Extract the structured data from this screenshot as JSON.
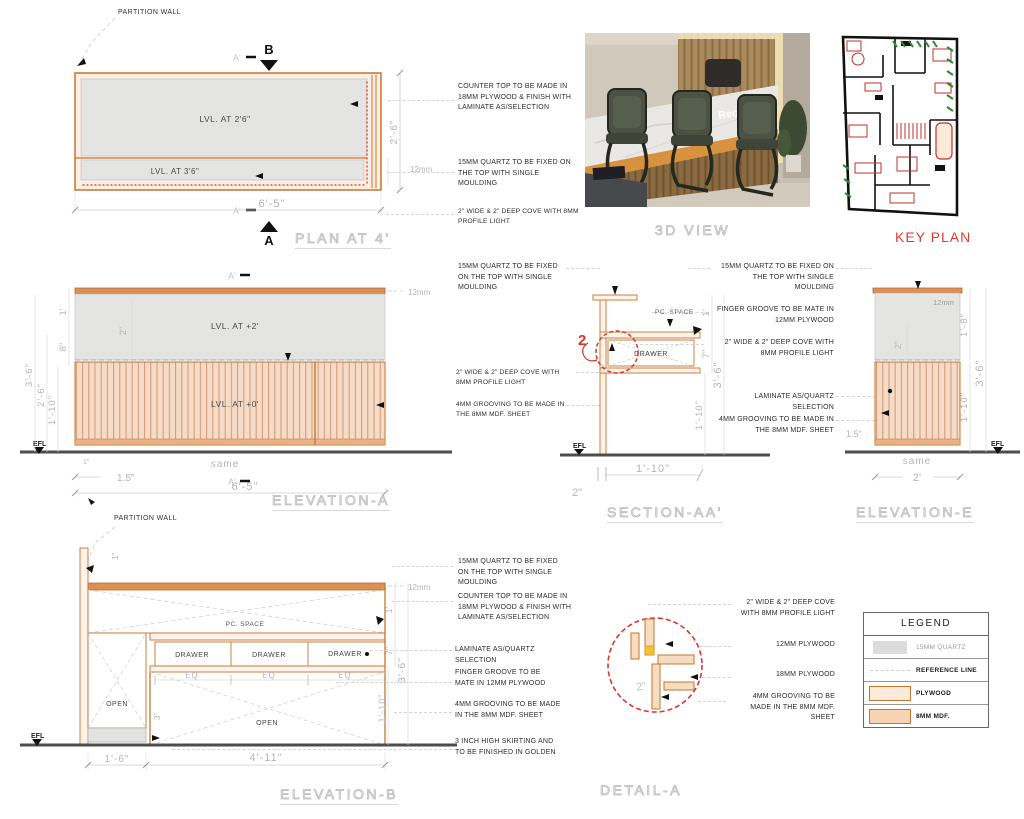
{
  "colors": {
    "plywood_stroke": "#c4752e",
    "plywood_fill": "#f6dcc8",
    "mdf_fill": "#f5d3b3",
    "quartz_fill": "#e4e4e2",
    "counter_strip": "#dd9055",
    "reference_line": "#8fb8b8",
    "detail_red": "#d8362c",
    "profile_light_yellow": "#f2c235",
    "dim_text": "#b4b4b4",
    "ground": "#4d4d4d",
    "keyplan_title_red": "#e23c30"
  },
  "common": {
    "efl": "EFL"
  },
  "plan": {
    "title": "PLAN AT 4'",
    "partition_wall_label": "PARTITION WALL",
    "lvl_upper": "LVL. AT 2'6\"",
    "lvl_lower": "LVL. AT 3'6\"",
    "dim_width": "6'-5\"",
    "dim_depth": "2'-6\"",
    "thickness_label": "12mm",
    "marker_b": "B",
    "marker_a": "A",
    "section_line_label": "A'"
  },
  "callouts_plan": {
    "counter_top": "COUNTER TOP TO BE MADE IN 18MM PLYWOOD & FINISH WITH LAMINATE AS/SELECTION",
    "quartz": "15MM QUARTZ TO BE FIXED ON THE TOP WITH SINGLE MOULDING",
    "cove": "2\" WIDE & 2\" DEEP COVE WITH 8MM PROFILE LIGHT"
  },
  "view3d": {
    "title": "3D VIEW",
    "sign_text": "Reception"
  },
  "keyplan": {
    "title": "KEY PLAN"
  },
  "elevation_a": {
    "title": "ELEVATION-A",
    "lvl_upper": "LVL. AT +2'",
    "lvl_lower": "LVL. AT +0'",
    "thickness_label": "12mm",
    "section_line_label": "A'",
    "dims": {
      "d36": "3'-6\"",
      "d26": "2'-6\"",
      "d110": "1'-10\"",
      "d1ft": "1'",
      "d8": "8\"",
      "d2": "2\"",
      "d1in": "1\"",
      "d15": "1.5\"",
      "same": "same",
      "width": "6'-5\""
    }
  },
  "callouts_mid": {
    "quartz": "15MM QUARTZ TO BE FIXED ON THE TOP WITH SINGLE MOULDING",
    "cove": "2\" WIDE & 2\" DEEP COVE WITH 8MM PROFILE LIGHT",
    "grooving": "4MM GROOVING TO BE MADE IN THE 8MM MDF. SHEET"
  },
  "section_aa": {
    "title": "SECTION-AA'",
    "pc_space": "PC. SPACE",
    "drawer": "DRAWER",
    "detail_marker": "2",
    "dims": {
      "d1ft": "1'",
      "d7": "7\"",
      "d110": "1'-10\"",
      "d36": "3'-6\"",
      "w110": "1'-10\"",
      "d2": "2\""
    }
  },
  "callouts_right": {
    "quartz": "15MM QUARTZ TO BE FIXED ON THE TOP WITH SINGLE MOULDING",
    "finger": "FINGER GROOVE TO BE MATE IN 12MM PLYWOOD",
    "cove": "2\" WIDE & 2\" DEEP COVE WITH 8MM PROFILE LIGHT",
    "laminate": "LAMINATE AS/QUARTZ SELECTION",
    "grooving": "4MM GROOVING TO BE MADE IN THE 8MM MDF. SHEET"
  },
  "elevation_e": {
    "title": "ELEVATION-E",
    "thickness_label": "12mm",
    "dims": {
      "d2": "2\"",
      "d18": "1'-8\"",
      "d110": "1'-10\"",
      "d36": "3'-6\"",
      "d15": "1.5\"",
      "same": "same",
      "width": "2'"
    }
  },
  "elevation_b": {
    "title": "ELEVATION-B",
    "partition_wall_label": "PARTITION WALL",
    "pc_space": "PC. SPACE",
    "drawer": "DRAWER",
    "open": "OPEN",
    "eq": "EQ",
    "thickness_label": "12mm",
    "dims": {
      "d1in": "1\"",
      "d16": "1'-6\"",
      "d411": "4'-11\"",
      "d3": "3\"",
      "d1ft": "1'",
      "d7": "7\"",
      "d110": "1'-10\"",
      "d36": "3'-6\""
    }
  },
  "callouts_bottom": {
    "quartz": "15MM QUARTZ TO BE FIXED ON THE TOP WITH SINGLE MOULDING",
    "counter_top": "COUNTER TOP TO BE MADE IN 18MM PLYWOOD & FINISH WITH LAMINATE AS/SELECTION",
    "laminate": "LAMINATE AS/QUARTZ SELECTION",
    "finger": "FINGER GROOVE TO BE MATE IN 12MM PLYWOOD",
    "grooving": "4MM GROOVING TO BE MADE IN THE 8MM MDF. SHEET",
    "skirting": "3 INCH HIGH SKIRTING AND TO BE FINISHED IN GOLDEN"
  },
  "detail_a": {
    "title": "DETAIL-A",
    "dim2": "2\"",
    "callouts": {
      "cove": "2\" WIDE & 2\" DEEP COVE WITH 8MM PROFILE LIGHT",
      "ply12": "12MM PLYWOOD",
      "ply18": "18MM PLYWOOD",
      "grooving": "4MM GROOVING TO BE MADE IN THE 8MM MDF. SHEET"
    }
  },
  "legend": {
    "title": "LEGEND",
    "rows": [
      {
        "key": "quartz",
        "label": "15MM QUARTZ"
      },
      {
        "key": "reference-line",
        "label": "REFERENCE LINE"
      },
      {
        "key": "plywood",
        "label": "PLYWOOD"
      },
      {
        "key": "mdf",
        "label": "8MM MDF."
      }
    ]
  }
}
